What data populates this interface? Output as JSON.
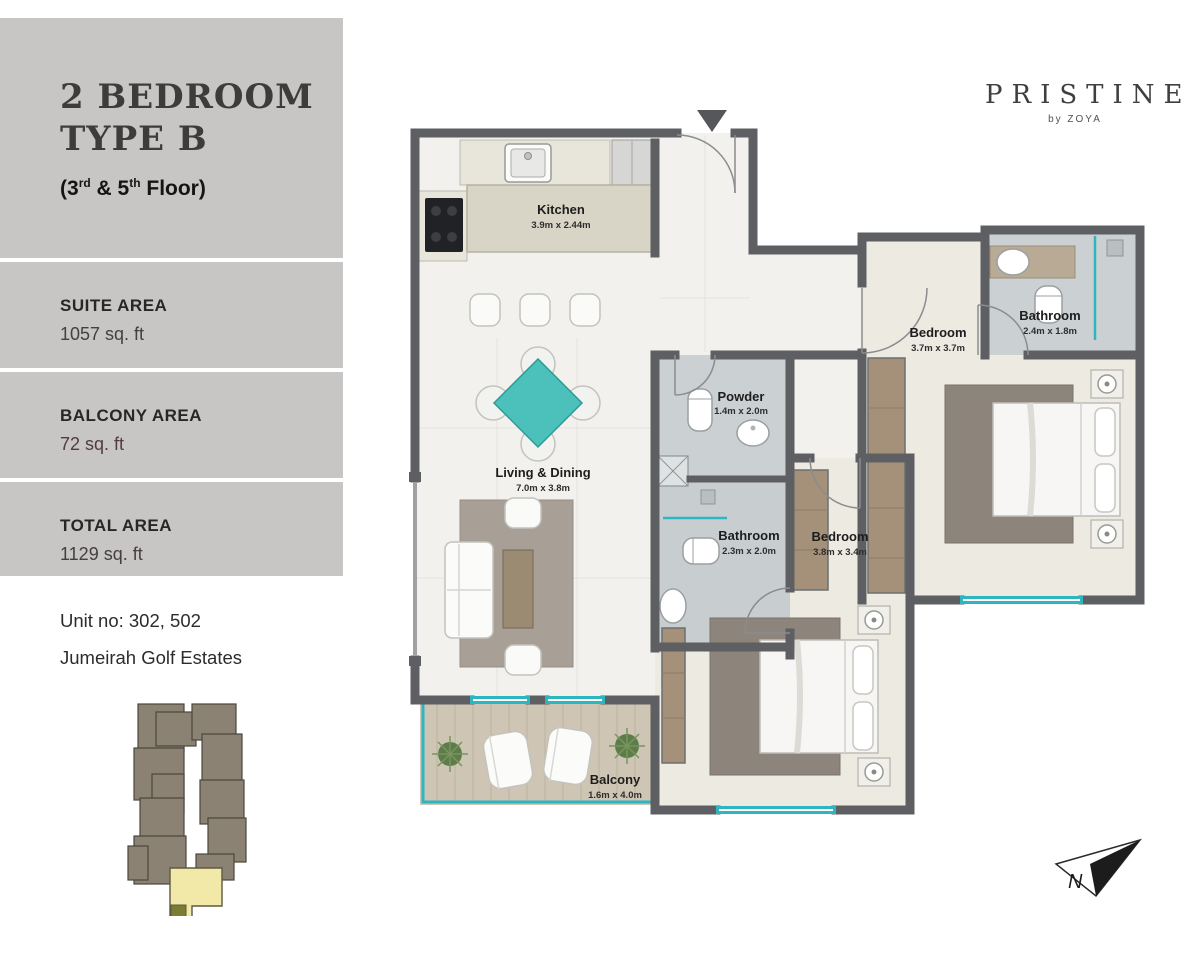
{
  "sidebar": {
    "title_line1": "2 BEDROOM",
    "title_line2": "TYPE B",
    "floor_note": {
      "p1": "(3",
      "s1": "rd",
      "p2": " & 5",
      "s2": "th",
      "p3": " Floor)"
    },
    "areas": {
      "suite": {
        "label": "SUITE AREA",
        "value": "1057 sq. ft"
      },
      "balcony": {
        "label": "BALCONY AREA",
        "value": "72 sq. ft"
      },
      "total": {
        "label": "TOTAL AREA",
        "value": "1129 sq. ft"
      }
    },
    "unit_no": "Unit no: 302, 502",
    "community": "Jumeirah Golf Estates"
  },
  "brand": {
    "name": "PRISTINE",
    "byline": "by ZOYA"
  },
  "floorplan": {
    "kitchen": {
      "name": "Kitchen",
      "dims": "3.9m x 2.44m"
    },
    "living": {
      "name": "Living & Dining",
      "dims": "7.0m x 3.8m"
    },
    "powder": {
      "name": "Powder",
      "dims": "1.4m x 2.0m"
    },
    "bathroom1": {
      "name": "Bathroom",
      "dims": "2.3m x 2.0m"
    },
    "bedroom1": {
      "name": "Bedroom",
      "dims": "3.8m x 3.4m"
    },
    "bedroom2": {
      "name": "Bedroom",
      "dims": "3.7m x 3.7m"
    },
    "bathroom2": {
      "name": "Bathroom",
      "dims": "2.4m x 1.8m"
    },
    "balcony": {
      "name": "Balcony",
      "dims": "1.6m x 4.0m"
    }
  },
  "compass": {
    "letter": "N"
  },
  "colors": {
    "sidebar_gray": "#c7c6c4",
    "wall": "#5d5f62",
    "teal_accent": "#2db5c2",
    "balcony_value_maroon": "#533b42",
    "keyplan_unit_highlight": "#f2e9a8",
    "keyplan_building": "#8b8273"
  }
}
